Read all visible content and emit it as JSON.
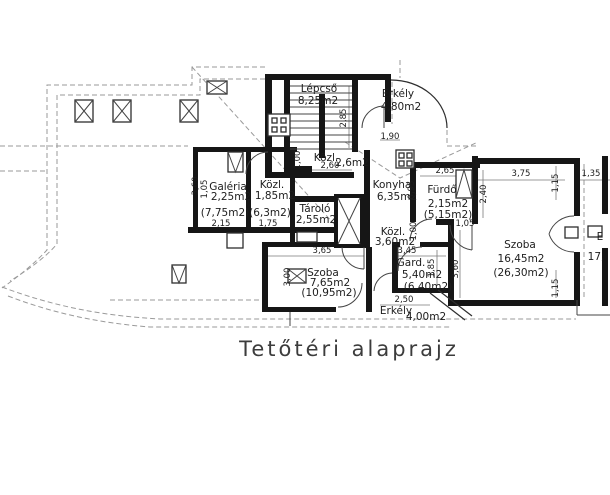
{
  "title": "Tetőtéri alaprajz",
  "rooms": {
    "lepcso": {
      "name": "Lépcső",
      "area": "8,25m2"
    },
    "erkely_felso": {
      "name": "Erkély",
      "area": "4,80m2"
    },
    "konyha": {
      "name": "Konyha",
      "area": "6,35m2"
    },
    "furdo": {
      "name": "Fürdő",
      "area": "2,15m2",
      "gross": "(5,15m2)"
    },
    "galeria": {
      "name": "Galéria",
      "area": "2,25m2",
      "gross": "(7,75m2)"
    },
    "kozl_galeria": {
      "name": "Közl.",
      "area": "1,85m2",
      "gross": "(6,3m2)"
    },
    "kozl_lepcso": {
      "name": "Közl.",
      "area": "2,6m2"
    },
    "tarolo": {
      "name": "Tároló",
      "area": "2,55m2"
    },
    "kozl_kozep": {
      "name": "Közl.",
      "area": "3,60m2"
    },
    "szoba_nagy": {
      "name": "Szoba",
      "area": "16,45m2",
      "gross": "(26,30m2)"
    },
    "szoba_kis": {
      "name": "Szoba",
      "area": "7,65m2",
      "gross": "(10,95m2)"
    },
    "gard": {
      "name": "Gard.",
      "area": "5,40m2",
      "gross": "(6,40m2)"
    },
    "erkely_also": {
      "name": "Erkély",
      "area": "4,00m2"
    },
    "erkely_jobb": {
      "name": "E",
      "area": "17,"
    }
  },
  "dimensions": {
    "lepcso_h": "2,85",
    "erkely_felso_w": "1,90",
    "kozl_lepcso_w": "2,60",
    "kozl_lepcso_h": "1,00",
    "galeria_h": "3,60",
    "galeria_h2": "1,05",
    "galeria_w": "2,15",
    "kozl_galeria_w": "1,75",
    "furdo_w": "2,65",
    "furdo_h": "0,95",
    "furdo_h2": "2,40",
    "furdo_ajto": "1,05",
    "szoba_nagy_w": "3,75",
    "szoba_nagy_k1": "1,15",
    "jobb_w": "1,35",
    "szoba_nagy_ny": "3,60",
    "szoba_nagy_k2": "1,15",
    "kozl_kozep_h": "1,00",
    "gard_w": "3,45",
    "gard_h": "1,85",
    "erkely_also_w": "2,50",
    "szoba_kis_w": "3,65",
    "szoba_kis_h": "3,00"
  }
}
